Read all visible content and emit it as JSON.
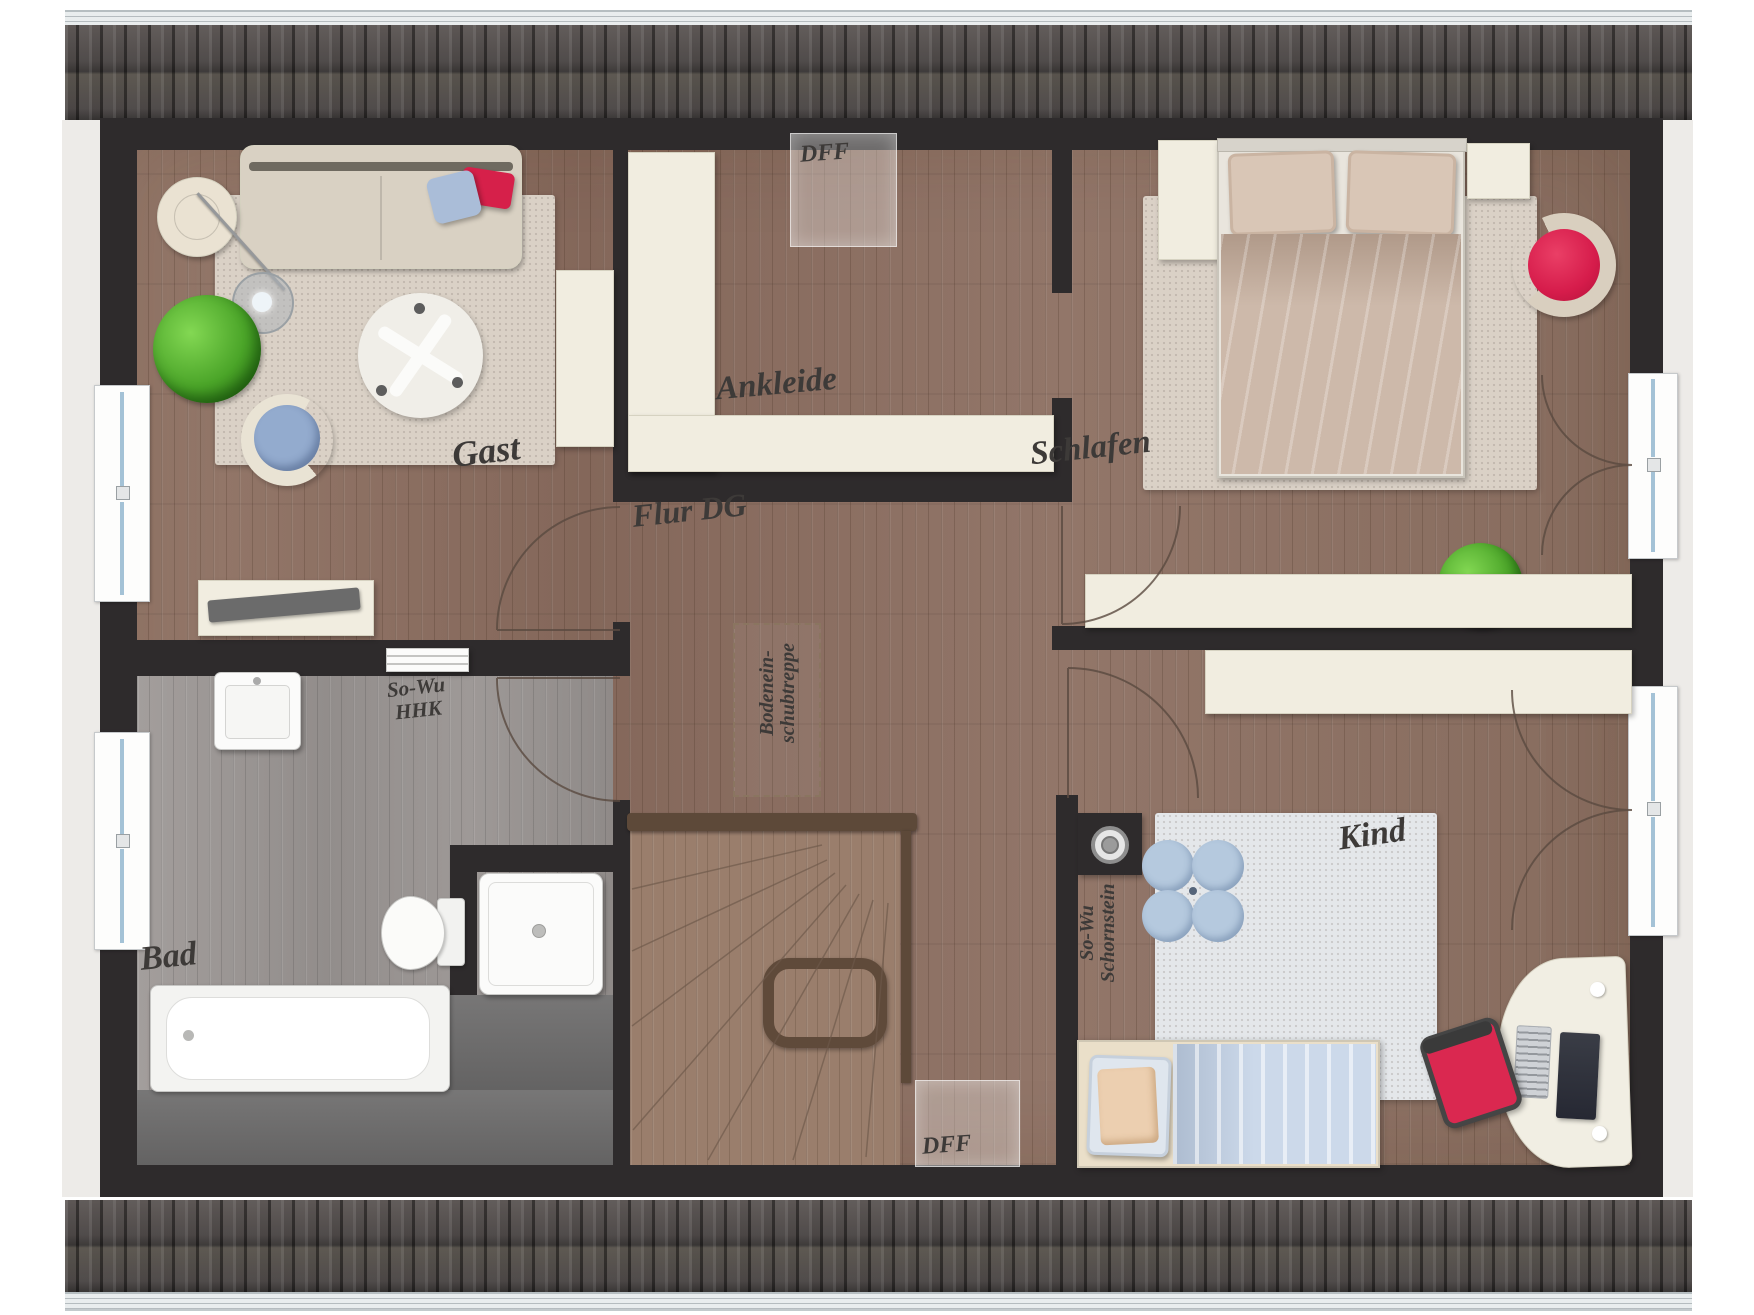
{
  "rooms": {
    "gast": "Gast",
    "ankleide": "Ankleide",
    "schlafen": "Schlafen",
    "flur": "Flur DG",
    "bad": "Bad",
    "kind": "Kind"
  },
  "annotations": {
    "roof_window": "DFF",
    "hhk_line1": "So-Wu",
    "hhk_line2": "HHK",
    "chimney_line1": "So-Wu",
    "chimney_line2": "Schornstein",
    "attic_line1": "Bodenein-",
    "attic_line2": "schubtreppe"
  },
  "colors": {
    "wall": "#2e2b2c",
    "roof": "#45403e",
    "wood_floor": "#8d7262",
    "bath_floor": "#9c9795",
    "furniture_cream": "#f1ede0",
    "rug_beige": "#dad1c6",
    "rug_blue": "#e4e7ea",
    "accent_red": "#da2150",
    "pillow_blue": "#a9bdd8",
    "plant_green": "#4fae2e",
    "label_ink": "#3d3a38"
  }
}
